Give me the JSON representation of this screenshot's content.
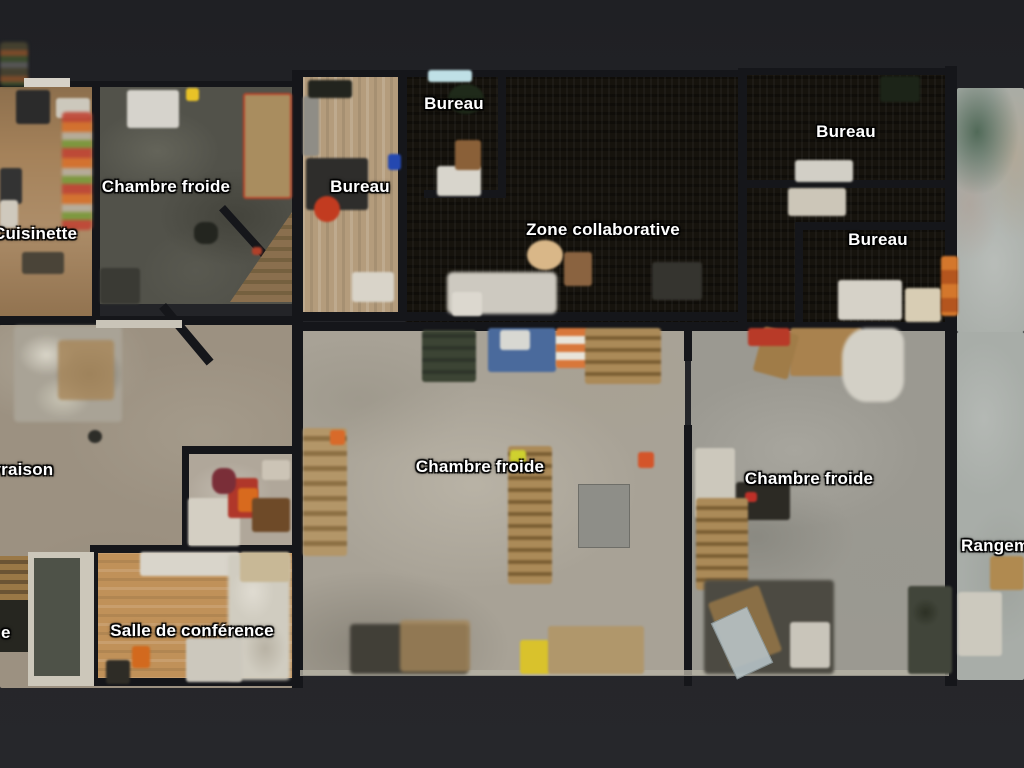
{
  "view": {
    "description": "Top-down dollhouse floor plan of a warehouse and office space with French room labels"
  },
  "labels": [
    {
      "id": "chambre-froide-1",
      "text": "Chambre froide",
      "x": 166,
      "y": 187,
      "anchor": "center"
    },
    {
      "id": "cuisinette",
      "text": "Cuisinette",
      "x": -7,
      "y": 234,
      "anchor": "left"
    },
    {
      "id": "bureau-1",
      "text": "Bureau",
      "x": 360,
      "y": 187,
      "anchor": "center"
    },
    {
      "id": "bureau-2",
      "text": "Bureau",
      "x": 454,
      "y": 104,
      "anchor": "center"
    },
    {
      "id": "zone-collaborative",
      "text": "Zone collaborative",
      "x": 603,
      "y": 230,
      "anchor": "center"
    },
    {
      "id": "bureau-3",
      "text": "Bureau",
      "x": 846,
      "y": 132,
      "anchor": "center"
    },
    {
      "id": "bureau-4",
      "text": "Bureau",
      "x": 878,
      "y": 240,
      "anchor": "center"
    },
    {
      "id": "livraison",
      "text": "Livraison",
      "x": -24,
      "y": 470,
      "anchor": "left"
    },
    {
      "id": "chambre-froide-2",
      "text": "Chambre froide",
      "x": 480,
      "y": 467,
      "anchor": "center"
    },
    {
      "id": "chambre-froide-3",
      "text": "Chambre froide",
      "x": 809,
      "y": 479,
      "anchor": "center"
    },
    {
      "id": "rangement",
      "text": "Rangement",
      "x": 961,
      "y": 546,
      "anchor": "left"
    },
    {
      "id": "salle-de-conference",
      "text": "Salle de conférence",
      "x": 192,
      "y": 631,
      "anchor": "center"
    },
    {
      "id": "partial-label",
      "text": "e",
      "x": 1,
      "y": 633,
      "anchor": "left"
    }
  ],
  "palette": {
    "background": "#232428",
    "wall": "#15161a",
    "label-text": "#ffffff",
    "concrete-warm": "#9c9181",
    "concrete-mid": "#a8a296",
    "concrete-cool": "#9b9991",
    "floor-dark": "#16130d",
    "floor-olive": "#52524a",
    "wood-light": "#b49c7c",
    "wood-oak": "#c09159",
    "wood-kitchen": "#a5825a",
    "floor-pale": "#a8ada8",
    "pallet": "#ab8a58",
    "white-object": "#d3d0c6",
    "accent-orange": "#d86a2a",
    "accent-red": "#b83a28",
    "accent-yellow": "#d9c22c",
    "accent-blue": "#4a6a9c",
    "ramp": "#4e5248"
  }
}
